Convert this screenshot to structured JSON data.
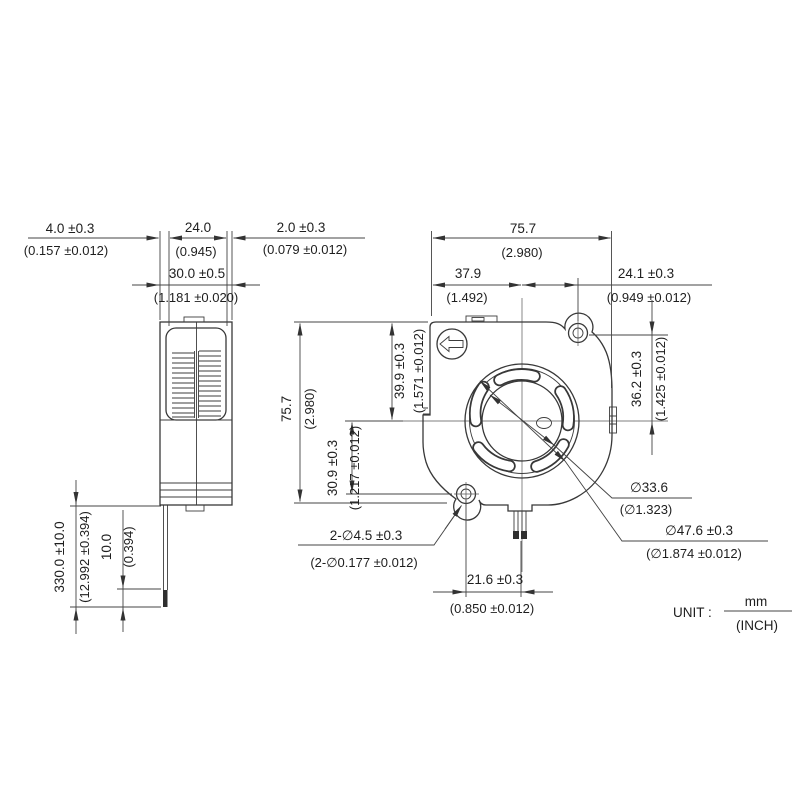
{
  "drawing": {
    "unit_note": {
      "label": "UNIT :",
      "numerator": "mm",
      "denominator": "(INCH)"
    },
    "side_view": {
      "dims": {
        "flange_left": {
          "mm": "4.0 ±0.3",
          "inch": "(0.157 ±0.012)"
        },
        "vent_width": {
          "mm": "24.0",
          "inch": "(0.945)"
        },
        "flange_right": {
          "mm": "2.0 ±0.3",
          "inch": "(0.079 ±0.012)"
        },
        "overall_width": {
          "mm": "30.0 ±0.5",
          "inch": "(1.181 ±0.020)"
        },
        "lead_wire_length": {
          "mm": "330.0 ±10.0",
          "inch": "(12.992 ±0.394)"
        },
        "wire_strip_length": {
          "mm": "10.0",
          "inch": "(0.394)"
        }
      }
    },
    "front_view": {
      "dims": {
        "overall_width": {
          "mm": "75.7",
          "inch": "(2.980)"
        },
        "left_to_center": {
          "mm": "37.9",
          "inch": "(1.492)"
        },
        "center_to_hole_x": {
          "mm": "24.1 ±0.3",
          "inch": "(0.949 ±0.012)"
        },
        "top_to_center": {
          "mm": "39.9 ±0.3",
          "inch": "(1.571 ±0.012)"
        },
        "overall_height": {
          "mm": "75.7",
          "inch": "(2.980)"
        },
        "center_to_hole_y": {
          "mm": "30.9 ±0.3",
          "inch": "(1.217 ±0.012)"
        },
        "hole_to_center_y": {
          "mm": "36.2 ±0.3",
          "inch": "(1.425 ±0.012)"
        },
        "hub_diameter": {
          "mm": "∅33.6",
          "inch": "(∅1.323)"
        },
        "inlet_diameter": {
          "mm": "∅47.6 ±0.3",
          "inch": "(∅1.874 ±0.012)"
        },
        "mounting_holes": {
          "mm": "2-∅4.5 ±0.3",
          "inch": "(2-∅0.177 ±0.012)"
        },
        "hole_to_lead_x": {
          "mm": "21.6 ±0.3",
          "inch": "(0.850 ±0.012)"
        }
      }
    }
  }
}
